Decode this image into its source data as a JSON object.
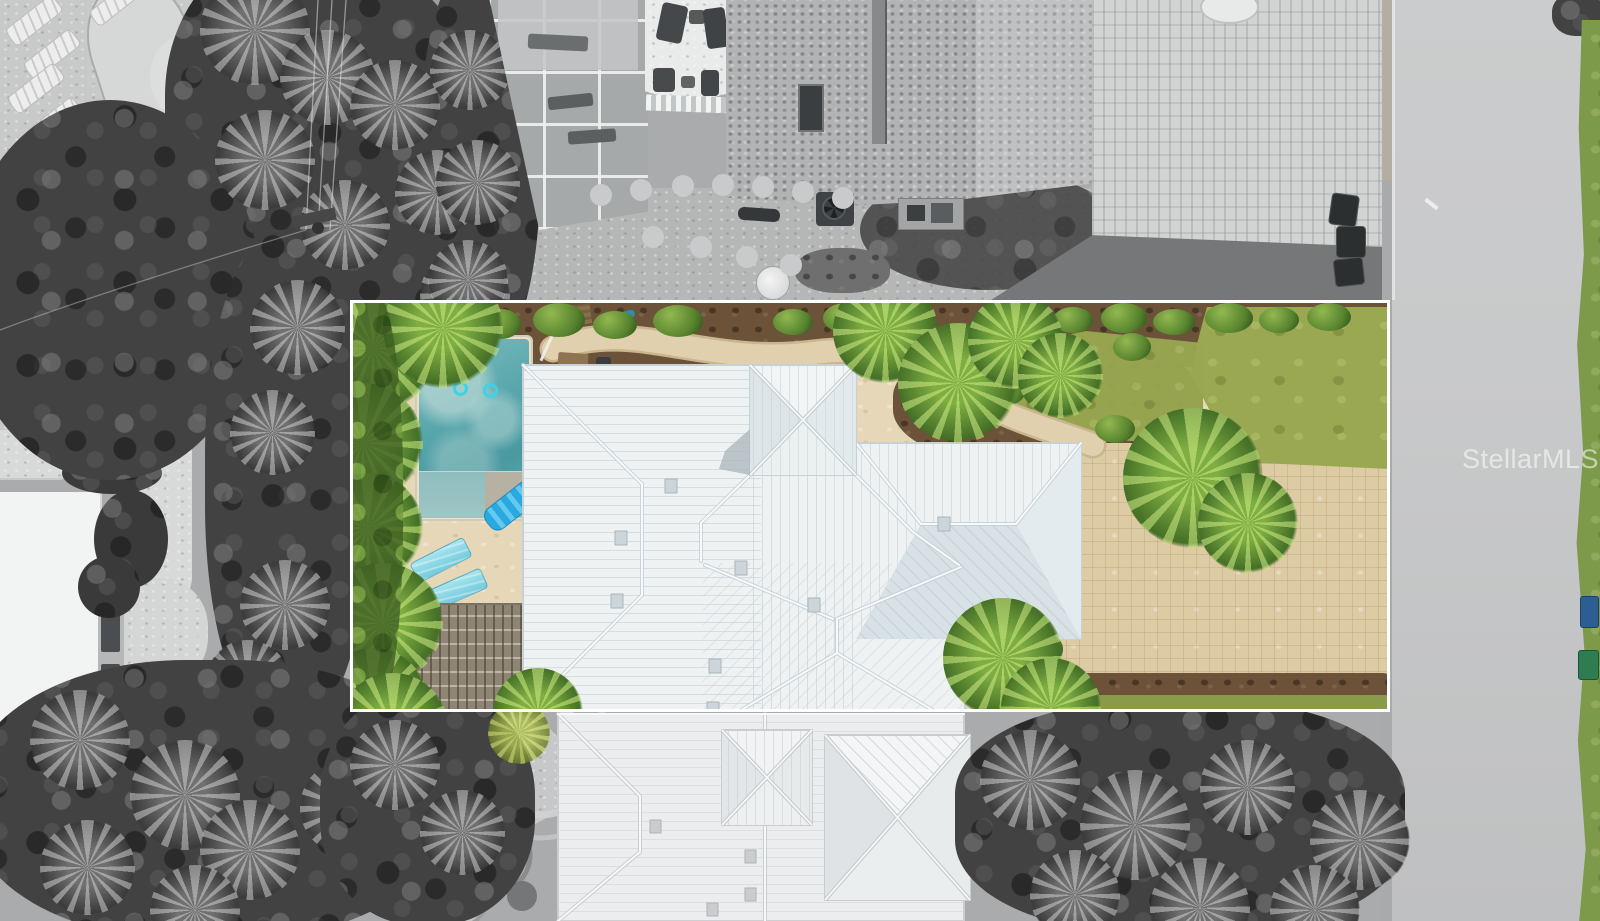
{
  "watermark": {
    "text": "StellarMLS"
  },
  "palette": {
    "c-line": "#ffffff",
    "c-pool": "#55a5ab",
    "c-float": "#2aa9e0",
    "c-lounge": "#a5e4ee",
    "c-sand": "#e6d7b8",
    "c-paver": "#ddcba4",
    "c-mulch": "#6b5238",
    "c-lawn": "#99a851",
    "c-palm": "#7fae43",
    "c-roof": "#eff2f3",
    "c-roof-shade": "#d8e1e5",
    "c-road": "#c8c9ca",
    "c-concrete": "#d3d4d4",
    "c-veg-gray": "#424243"
  }
}
